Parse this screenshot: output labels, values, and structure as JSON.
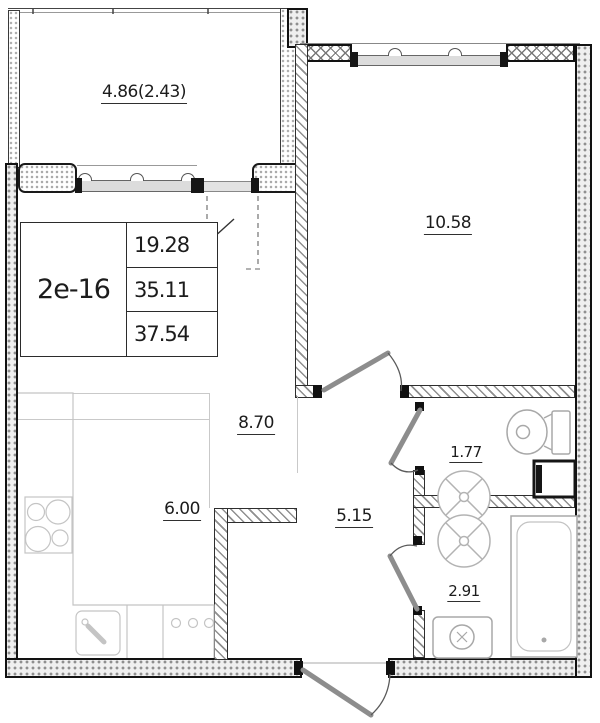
{
  "unit": {
    "id": "2е-16",
    "area_living": "19.28",
    "area_total": "35.11",
    "area_total_with_balcony": "37.54"
  },
  "rooms": {
    "balcony": "4.86(2.43)",
    "bedroom": "10.58",
    "living_room": "8.70",
    "kitchen": "6.00",
    "hallway": "5.15",
    "bathroom": "1.77",
    "shower_room": "2.91"
  },
  "colors": {
    "background": "#ffffff",
    "wall_line": "#141414",
    "partition_hatch": "#8f8f8f",
    "fixture_line": "#a8a8a8",
    "counter_line": "#c4c4c4",
    "label_text": "#1c1c1c"
  }
}
